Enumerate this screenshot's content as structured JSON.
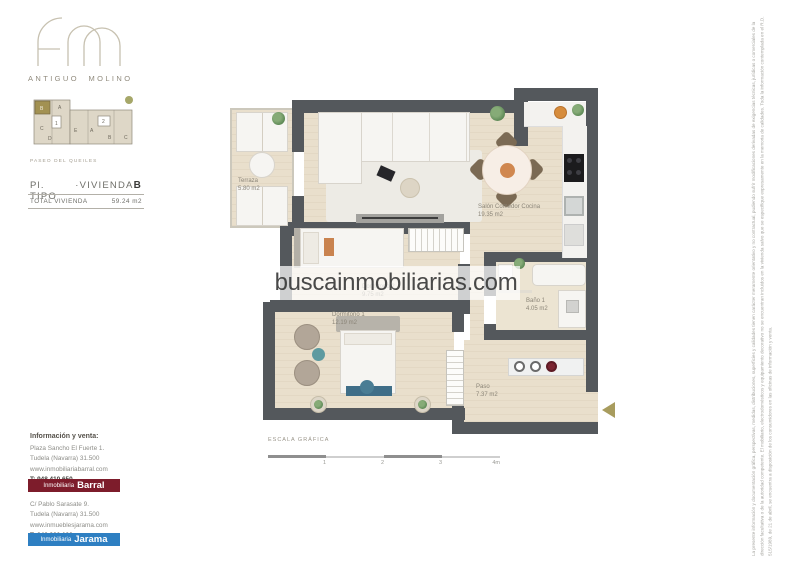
{
  "brand": {
    "name": "ANTIGUO MOLINO"
  },
  "keyplan": {
    "street": "PASEO DEL QUEILES",
    "units": [
      "B",
      "A",
      "C",
      "1",
      "D",
      "E",
      "A",
      "2",
      "B",
      "C"
    ],
    "highlighted_unit": "B"
  },
  "plan_header": {
    "plan_type": "Pl. TIPO",
    "dot": "·",
    "unit_label": "VIVIENDA",
    "unit_letter": "B",
    "total_label": "TOTAL VIVIENDA",
    "total_area": "59.24 m2"
  },
  "floorplan": {
    "rooms": [
      {
        "name": "Terraza",
        "area": "5.80 m2"
      },
      {
        "name": "Salón Comedor Cocina",
        "area": "19.35 m2"
      },
      {
        "name": "Dormitorio 2",
        "area": "9.75 m2"
      },
      {
        "name": "Baño 1",
        "area": "4.05 m2"
      },
      {
        "name": "Dormitorio 1",
        "area": "12.19 m2"
      },
      {
        "name": "Paso",
        "area": "7.37 m2"
      }
    ]
  },
  "watermark": {
    "text": "buscainmobiliarias.com"
  },
  "scale_bar": {
    "label": "ESCALA GRÁFICA",
    "ticks": [
      "1",
      "2",
      "3",
      "4m"
    ]
  },
  "contact": {
    "heading": "Información y venta:",
    "agencies": [
      {
        "address": "Plaza Sancho El Fuerte 1.",
        "city": "Tudela (Navarra) 31.500",
        "web": "www.inmobiliariabarral.com",
        "phone": "T: 948 410 650",
        "brand_prefix": "Inmobiliaria",
        "brand_name": "Barral",
        "banner_color": "#7d1c2b"
      },
      {
        "address": "C/ Pablo Sarasate 9.",
        "city": "Tudela (Navarra) 31.500",
        "web": "www.inmueblesjarama.com",
        "phone": "T: 948 820 123",
        "brand_prefix": "Inmobiliaria",
        "brand_name": "Jarama",
        "banner_color": "#2e7fc2"
      }
    ]
  },
  "icons": {
    "entrance_arrow": "left-triangle",
    "tree_marker": "olive-circle"
  },
  "colors": {
    "wall": "#54585c",
    "floor": "#e9dfcc",
    "accent_gold": "#a89c5e",
    "keyplan_highlight": "#a29152",
    "barral_red": "#7d1c2b",
    "jarama_blue": "#2e7fc2",
    "watermark_text": "#3a3a3a"
  },
  "disclaimer": "La presente información y documentación gráfica, perspectivas, medidas, distribuciones, superficies y calidades tienen carácter meramente orientativo y no contractual, pudiendo sufrir modificaciones derivadas de exigencias técnicas, jurídicas o comerciales de la dirección facultativa o de la autoridad competente. El mobiliario, electrodomésticos y equipamiento decorativo no se encuentran incluidos en la vivienda salvo que se especifique expresamente en la memoria de calidades. Toda la información contemplada en el R.D. 515/1989, de 21 de abril, se encuentra a disposición de los consumidores en las oficinas de información y venta."
}
